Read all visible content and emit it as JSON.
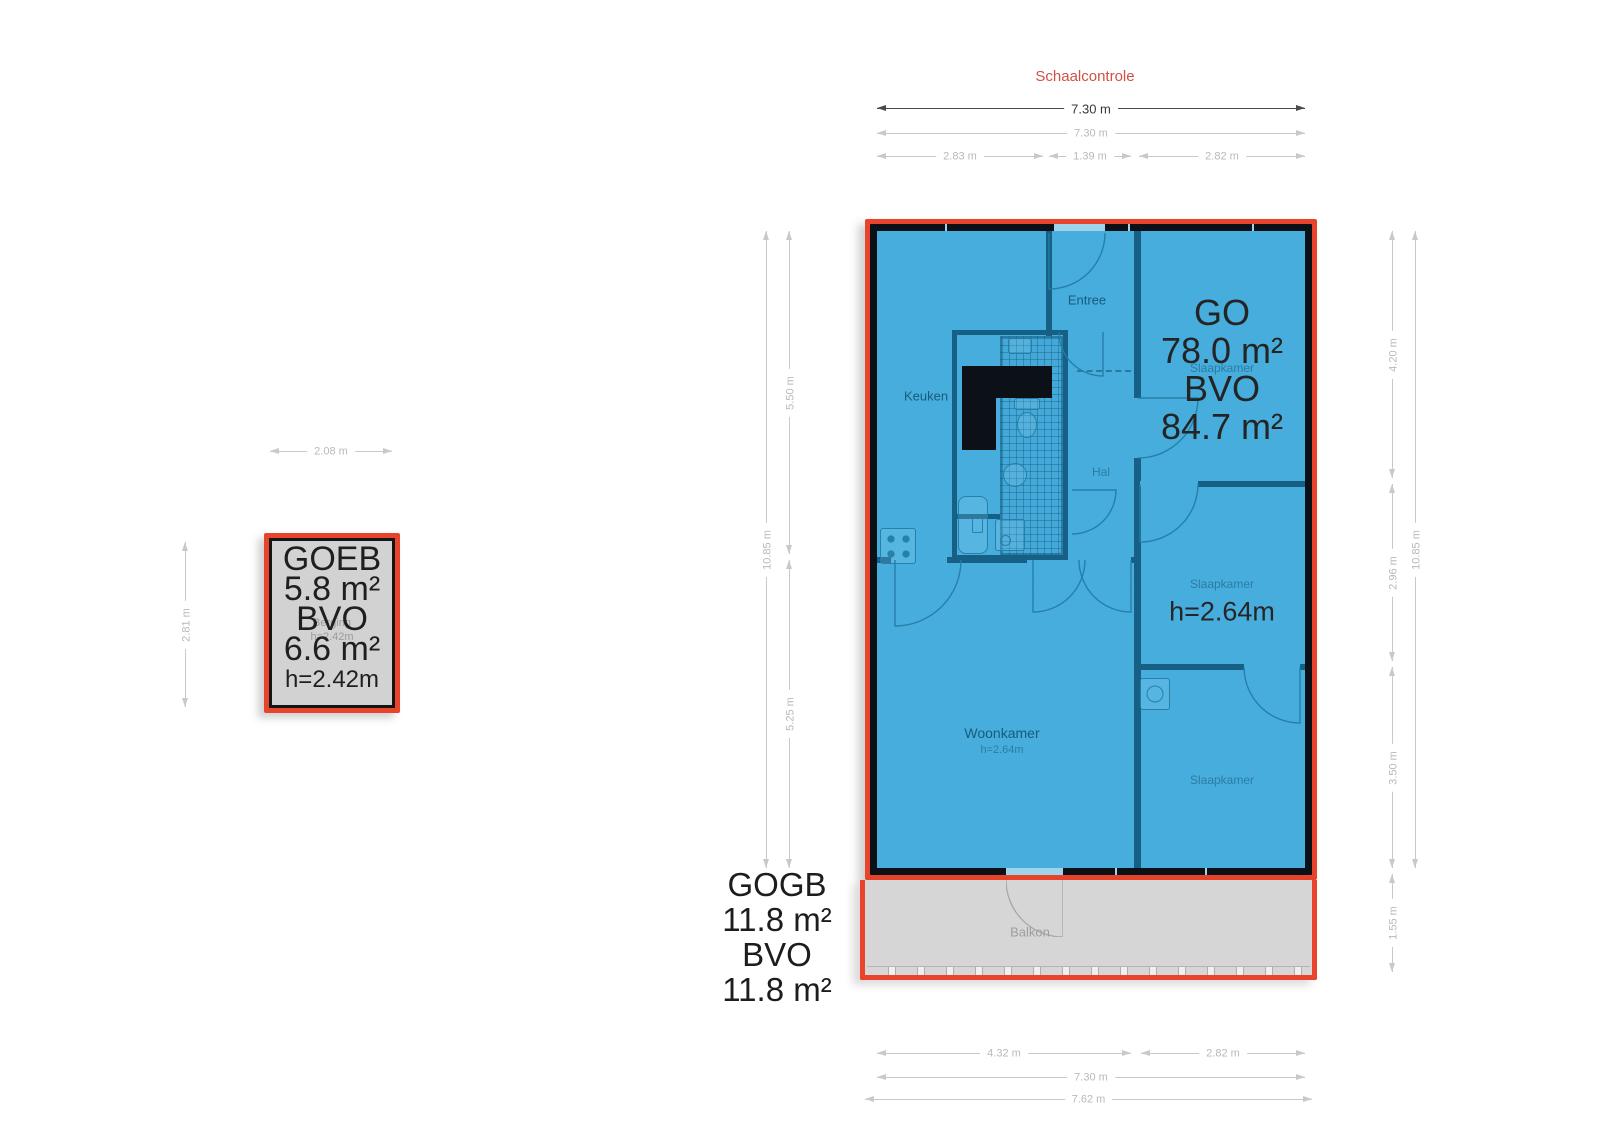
{
  "header": {
    "title": "Schaalcontrole"
  },
  "main_unit": {
    "usable_label": "GO",
    "usable_area": "78.0 m²",
    "gross_label": "BVO",
    "gross_area": "84.7 m²",
    "ceiling_height": "h=2.64m",
    "rooms": {
      "entree": "Entree",
      "keuken": "Keuken",
      "hal": "Hal",
      "slaapkamer_top": "Slaapkamer",
      "slaapkamer_mid": "Slaapkamer",
      "slaapkamer_bottom": "Slaapkamer",
      "woonkamer": "Woonkamer",
      "woonkamer_height": "h=2.64m",
      "balkon": "Balkon"
    }
  },
  "storage_unit": {
    "name": "GOEB",
    "usable_area": "5.8 m²",
    "gross_label": "BVO",
    "gross_area": "6.6 m²",
    "ceiling_height": "h=2.42m",
    "room_name": "Berging",
    "room_height": "h=2.42m"
  },
  "balcony_unit": {
    "name": "GOGB",
    "usable_area": "11.8 m²",
    "gross_label": "BVO",
    "gross_area": "11.8 m²"
  },
  "dimensions": {
    "top": {
      "primary": "7.30 m",
      "secondary": "7.30 m",
      "segments": [
        "2.83 m",
        "1.39 m",
        "2.82 m"
      ]
    },
    "bottom": {
      "segments": [
        "4.32 m",
        "2.82 m"
      ],
      "total": "7.30 m",
      "overall": "7.62 m"
    },
    "left": {
      "total": "10.85 m",
      "segments": [
        "5.50 m",
        "5.25 m"
      ]
    },
    "right": {
      "segments": [
        "4.20 m",
        "2.96 m",
        "3.50 m",
        "1.55 m"
      ],
      "total": "10.85 m"
    },
    "storage": {
      "width": "2.08 m",
      "height": "2.81 m"
    }
  },
  "colors": {
    "highlight_blue": "#47ADDD",
    "outline_red": "#E8432B",
    "balcony_gray": "#D6D6D6",
    "wall_black": "#0C1117",
    "wall_teal": "#156084",
    "dim_light": "#C9C9C9",
    "dim_dark": "#4A4A4A",
    "title_red": "#CD5246"
  }
}
